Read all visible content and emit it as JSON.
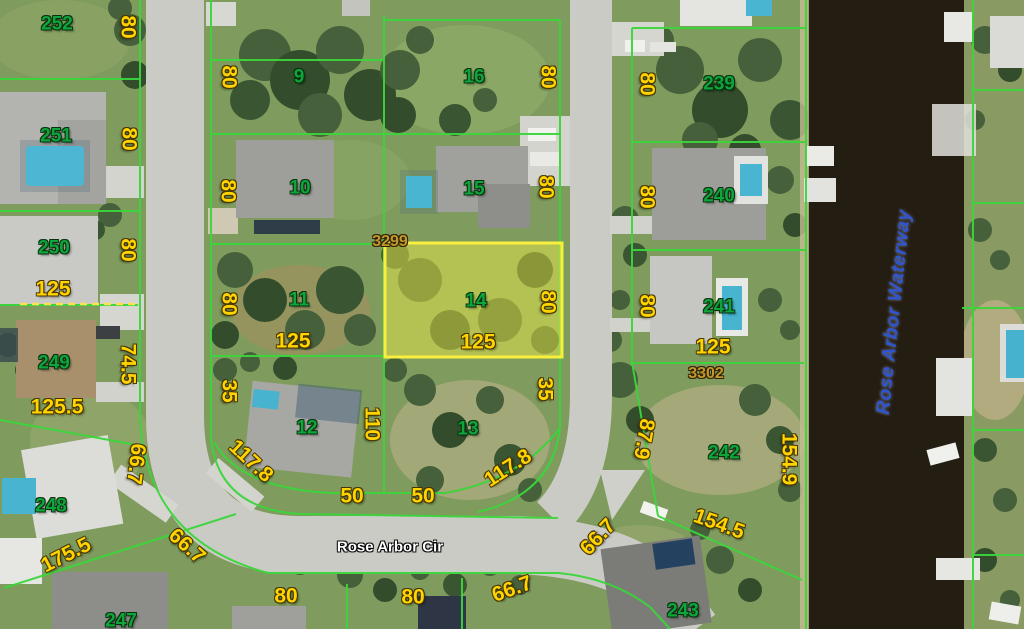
{
  "map": {
    "street_label": "Rose Arbor Cir",
    "waterway_label": "Rose Arbor Waterway",
    "highlighted_lot": {
      "number": "14",
      "address": "3299",
      "frontage": "125",
      "depth": "80"
    },
    "colors": {
      "lot_line": "#3bd63b",
      "lot_number_text": "#0da53c",
      "dimension_text": "#ffd400",
      "address_text": "#c09a2b",
      "highlight_fill": "rgba(247,240,70,0.45)",
      "highlight_border": "#f8ef3e",
      "road": "#cbcbc5",
      "water": "#241d12",
      "waterway_text": "#2f55cc"
    },
    "lot_numbers": [
      {
        "t": "252",
        "x": 57,
        "y": 24
      },
      {
        "t": "251",
        "x": 56,
        "y": 136
      },
      {
        "t": "250",
        "x": 54,
        "y": 248
      },
      {
        "t": "249",
        "x": 54,
        "y": 363
      },
      {
        "t": "248",
        "x": 51,
        "y": 506
      },
      {
        "t": "247",
        "x": 121,
        "y": 621
      },
      {
        "t": "9",
        "x": 299,
        "y": 77
      },
      {
        "t": "10",
        "x": 300,
        "y": 188
      },
      {
        "t": "11",
        "x": 299,
        "y": 300
      },
      {
        "t": "12",
        "x": 307,
        "y": 428
      },
      {
        "t": "13",
        "x": 468,
        "y": 429
      },
      {
        "t": "14",
        "x": 476,
        "y": 301
      },
      {
        "t": "15",
        "x": 474,
        "y": 189
      },
      {
        "t": "16",
        "x": 474,
        "y": 77
      },
      {
        "t": "239",
        "x": 719,
        "y": 84
      },
      {
        "t": "240",
        "x": 719,
        "y": 196
      },
      {
        "t": "241",
        "x": 719,
        "y": 307
      },
      {
        "t": "242",
        "x": 724,
        "y": 453
      },
      {
        "t": "243",
        "x": 683,
        "y": 611
      }
    ],
    "dimensions": [
      {
        "t": "80",
        "x": 128,
        "y": 27,
        "r": 90
      },
      {
        "t": "80",
        "x": 129,
        "y": 139,
        "r": 90
      },
      {
        "t": "80",
        "x": 128,
        "y": 250,
        "r": 90
      },
      {
        "t": "125",
        "x": 53,
        "y": 289,
        "r": 0
      },
      {
        "t": "74.5",
        "x": 128,
        "y": 364,
        "r": 90
      },
      {
        "t": "125.5",
        "x": 57,
        "y": 407,
        "r": 0
      },
      {
        "t": "66.7",
        "x": 136,
        "y": 464,
        "r": 97
      },
      {
        "t": "175.5",
        "x": 66,
        "y": 555,
        "r": -27
      },
      {
        "t": "66.7",
        "x": 187,
        "y": 546,
        "r": 42
      },
      {
        "t": "80",
        "x": 229,
        "y": 77,
        "r": 90
      },
      {
        "t": "80",
        "x": 228,
        "y": 191,
        "r": 90
      },
      {
        "t": "80",
        "x": 229,
        "y": 304,
        "r": 90
      },
      {
        "t": "35",
        "x": 229,
        "y": 391,
        "r": 90
      },
      {
        "t": "117.8",
        "x": 251,
        "y": 461,
        "r": 43
      },
      {
        "t": "125",
        "x": 293,
        "y": 341,
        "r": 0
      },
      {
        "t": "110",
        "x": 372,
        "y": 424,
        "r": 90
      },
      {
        "t": "50",
        "x": 352,
        "y": 496,
        "r": 0
      },
      {
        "t": "80",
        "x": 286,
        "y": 596,
        "r": 0
      },
      {
        "t": "80",
        "x": 548,
        "y": 77,
        "r": 90
      },
      {
        "t": "80",
        "x": 546,
        "y": 187,
        "r": 90
      },
      {
        "t": "80",
        "x": 548,
        "y": 302,
        "r": 90
      },
      {
        "t": "125",
        "x": 478,
        "y": 342,
        "r": 0
      },
      {
        "t": "35",
        "x": 545,
        "y": 389,
        "r": 90
      },
      {
        "t": "117.8",
        "x": 508,
        "y": 468,
        "r": -33
      },
      {
        "t": "50",
        "x": 423,
        "y": 496,
        "r": 0
      },
      {
        "t": "80",
        "x": 413,
        "y": 597,
        "r": 0
      },
      {
        "t": "66.7",
        "x": 512,
        "y": 589,
        "r": -20
      },
      {
        "t": "66.7",
        "x": 598,
        "y": 537,
        "r": -47
      },
      {
        "t": "80",
        "x": 647,
        "y": 84,
        "r": 90
      },
      {
        "t": "80",
        "x": 647,
        "y": 197,
        "r": 90
      },
      {
        "t": "80",
        "x": 647,
        "y": 306,
        "r": 90
      },
      {
        "t": "125",
        "x": 713,
        "y": 347,
        "r": 0
      },
      {
        "t": "87.9",
        "x": 644,
        "y": 439,
        "r": 100
      },
      {
        "t": "154.9",
        "x": 789,
        "y": 459,
        "r": 90
      },
      {
        "t": "154.5",
        "x": 719,
        "y": 524,
        "r": 20
      }
    ],
    "addresses": [
      {
        "t": "3299",
        "x": 390,
        "y": 242
      },
      {
        "t": "3302",
        "x": 706,
        "y": 374
      }
    ],
    "street_label_pos": {
      "x": 390,
      "y": 547
    },
    "waterway_label_pos": {
      "x": 894,
      "y": 312,
      "r": -84
    }
  }
}
